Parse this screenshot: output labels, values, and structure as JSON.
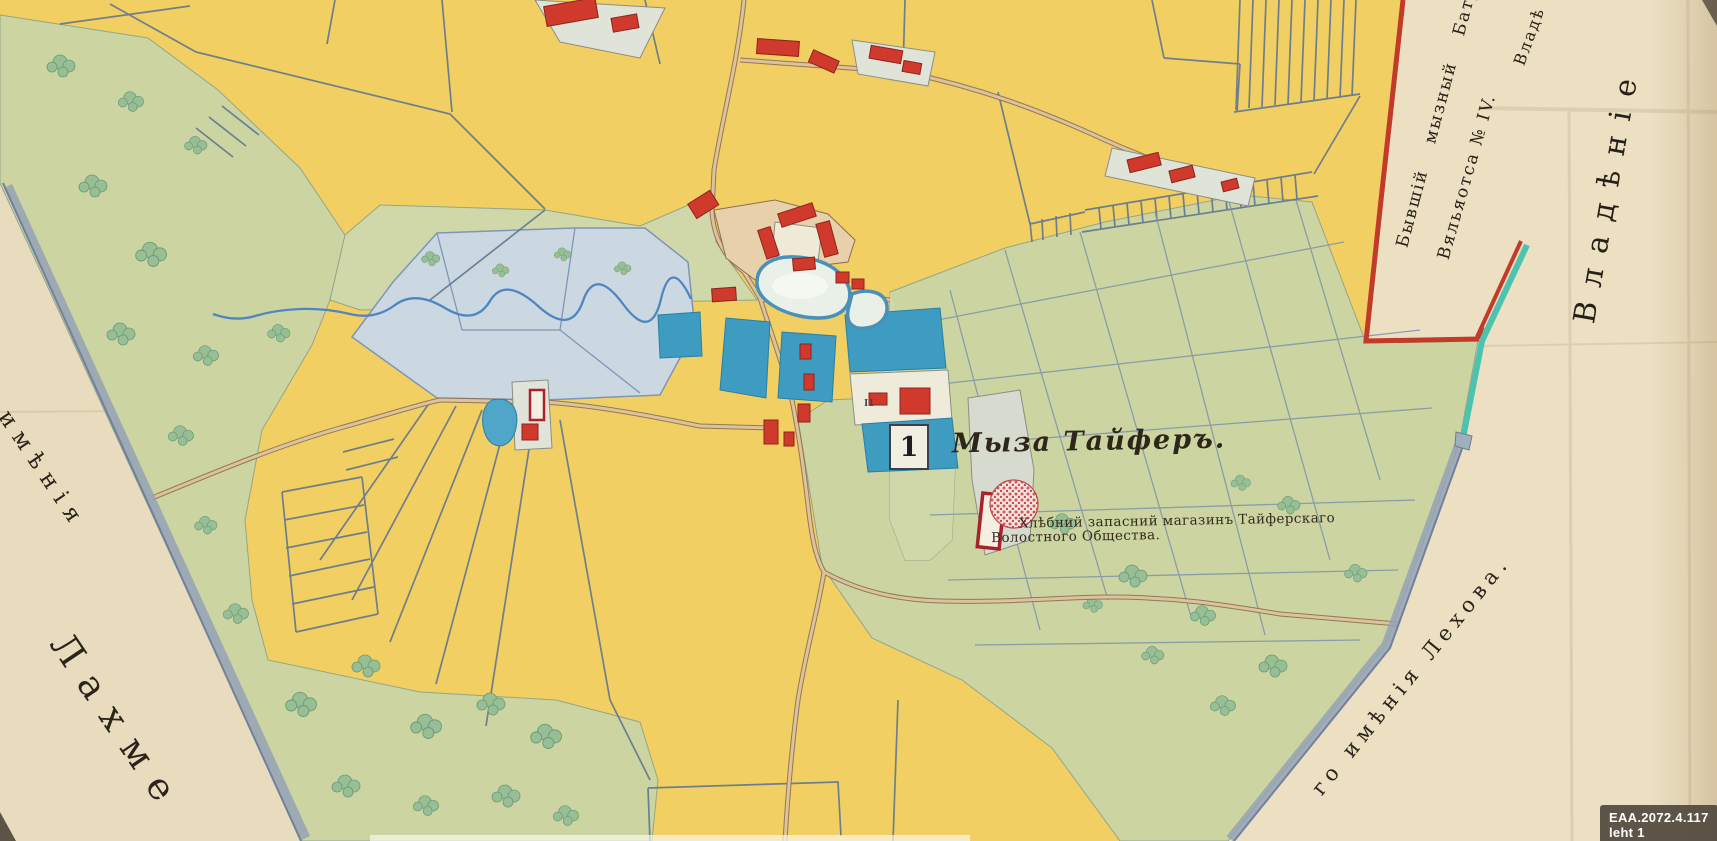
{
  "map": {
    "title": "Мыза Тайферъ.",
    "plot_number": "1",
    "plot_mark": "II",
    "caption": {
      "line1": "Хлѣбний запасний магазинъ Тайферскаго",
      "line2": "Волостного Общества."
    }
  },
  "margins": {
    "left": {
      "word1": "имѣнія",
      "word2": "Лахме"
    },
    "right": {
      "line1": "Бывшій мызный Батр",
      "line2": "Вяльяотса № IV.",
      "small": "Владѣ",
      "large": "Владѣніе"
    },
    "bottom_right": {
      "text": "го имѣнія Лехова."
    }
  },
  "badge": {
    "text": "EAA.2072.4.117 leht 1"
  },
  "colors": {
    "paper": "#EDE2C8",
    "field": "#F2CF62",
    "meadow": "#CBD6A4",
    "water": "#4FA6C8",
    "pond": "#E9F0E7",
    "building": "#D03A2C",
    "boundary_red": "#C23B2A",
    "boundary_teal": "#4CC2B0",
    "road": "#DDC29C",
    "line_blue": "#5F7590",
    "badge_bg": "#4A4238",
    "ink": "#2E2619"
  }
}
